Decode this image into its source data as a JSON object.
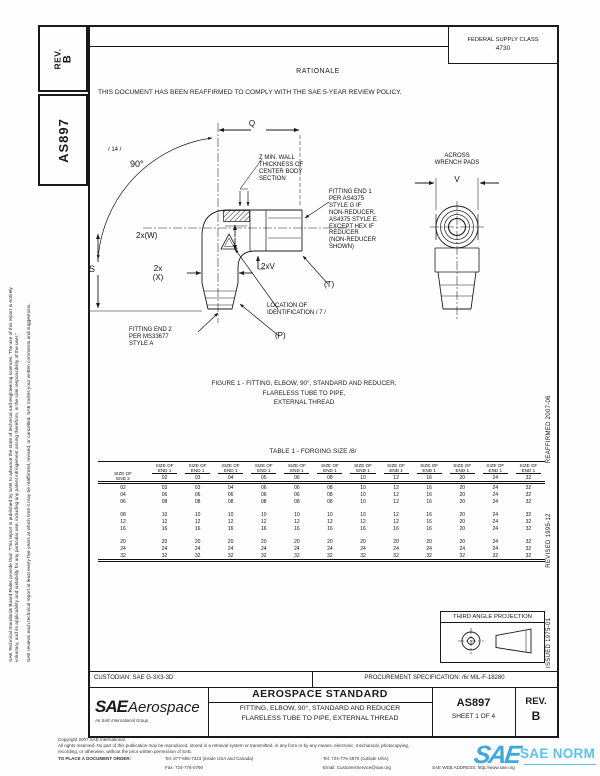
{
  "page": {
    "ink": "#1a1a1a",
    "watermark_blue": "#3fa9dc",
    "watermark_blue_light": "#5ec1ea"
  },
  "sidebar_left": {
    "disclaimer_line1": "SAE Technical Standards Board Rules provide that: \"This report is published by SAE to advance the state of technical and engineering sciences. The use of this report is entirely",
    "disclaimer_line2": "voluntary, and its applicability and suitability for any particular use, including any patent infringement arising therefrom, is the sole responsibility of the user.\"",
    "disclaimer_line3": "SAE reviews each technical report at least every five years at which time it may be reaffirmed, revised, or cancelled. SAE invites your written comments and suggestions.",
    "rev_label": "REV.",
    "rev_value": "B",
    "doc_number": "AS897"
  },
  "right_margin": {
    "issued": "ISSUED 1975-01",
    "revised": "REVISED 1995-12",
    "reaffirmed": "REAFFIRMED 2007-06"
  },
  "header": {
    "fsc_label": "FEDERAL SUPPLY CLASS",
    "fsc_value": "4730",
    "rationale_title": "RATIONALE",
    "rationale_text": "THIS DOCUMENT HAS BEEN REAFFIRMED TO COMPLY WITH THE SAE 5-YEAR REVIEW POLICY."
  },
  "figure": {
    "labels": {
      "flag_14": "/ 14 /",
      "angle_90": "90°",
      "dim_q": "Q",
      "z_note": "Z MIN. WALL\nTHICKNESS OF\nCENTER BODY\nSECTION",
      "end1_note": "FITTING END 1\nPER AS4375\nSTYLE G IF\nNON-REDUCER,\nAS4375 STYLE E\nEXCEPT HEX IF\nREDUCER\n(NON-REDUCER\nSHOWN)",
      "dim_2xw": "2x(W)",
      "dim_2xx": "2x\n(X)",
      "dim_s": "S",
      "dim_2xv": "2xV",
      "dim_t": "(T)",
      "id_note": "LOCATION OF\nIDENTIFICATION / 7 /",
      "dim_p": "(P)",
      "end2_note": "FITTING END 2\nPER MS33677\nSTYLE A",
      "across_wrench": "ACROSS\nWRENCH PADS",
      "dim_v": "V"
    },
    "caption": "FIGURE 1 - FITTING, ELBOW, 90°, STANDARD AND REDUCER,\nFLARELESS TUBE TO PIPE,\nEXTERNAL THREAD"
  },
  "table": {
    "title": "TABLE 1 - FORGING SIZE /8/",
    "corner_header": [
      "SIZE OF",
      "END 2"
    ],
    "col_header": [
      "SIZE OF",
      "END 1"
    ],
    "columns": [
      "02",
      "03",
      "04",
      "05",
      "06",
      "08",
      "10",
      "12",
      "16",
      "20",
      "24",
      "32"
    ],
    "row_groups": [
      {
        "rows": [
          {
            "end2": "02",
            "values": [
              "03",
              "03",
              "04",
              "06",
              "06",
              "08",
              "10",
              "12",
              "16",
              "20",
              "24",
              "32"
            ]
          },
          {
            "end2": "04",
            "values": [
              "06",
              "06",
              "06",
              "06",
              "06",
              "08",
              "10",
              "12",
              "16",
              "20",
              "24",
              "32"
            ]
          },
          {
            "end2": "06",
            "values": [
              "08",
              "08",
              "08",
              "08",
              "08",
              "08",
              "10",
              "12",
              "16",
              "20",
              "24",
              "32"
            ]
          }
        ]
      },
      {
        "rows": [
          {
            "end2": "08",
            "values": [
              "10",
              "10",
              "10",
              "10",
              "10",
              "10",
              "10",
              "12",
              "16",
              "20",
              "24",
              "32"
            ]
          },
          {
            "end2": "12",
            "values": [
              "12",
              "12",
              "12",
              "12",
              "12",
              "12",
              "12",
              "12",
              "16",
              "20",
              "24",
              "32"
            ]
          },
          {
            "end2": "16",
            "values": [
              "16",
              "16",
              "16",
              "16",
              "16",
              "16",
              "16",
              "16",
              "16",
              "20",
              "24",
              "32"
            ]
          }
        ]
      },
      {
        "rows": [
          {
            "end2": "20",
            "values": [
              "20",
              "20",
              "20",
              "20",
              "20",
              "20",
              "20",
              "20",
              "20",
              "20",
              "24",
              "32"
            ]
          },
          {
            "end2": "24",
            "values": [
              "24",
              "24",
              "24",
              "24",
              "24",
              "24",
              "24",
              "24",
              "24",
              "24",
              "24",
              "32"
            ]
          },
          {
            "end2": "32",
            "values": [
              "32",
              "32",
              "32",
              "32",
              "32",
              "32",
              "32",
              "32",
              "32",
              "32",
              "32",
              "32"
            ]
          }
        ]
      }
    ]
  },
  "projection": {
    "label": "THIRD ANGLE PROJECTION"
  },
  "title_block": {
    "custodian": "CUSTODIAN: SAE G-3X3-3D",
    "procurement": "PROCUREMENT SPECIFICATION: /6/ MIL-F-18280",
    "standard_type": "AEROSPACE STANDARD",
    "doc_title_line1": "FITTING, ELBOW, 90°, STANDARD AND REDUCER",
    "doc_title_line2": "FLARELESS TUBE TO PIPE, EXTERNAL THREAD",
    "doc_number": "AS897",
    "sheet": "SHEET 1 OF 4",
    "rev_label": "REV.",
    "rev_value": "B",
    "logo_sae": "SAE",
    "logo_aerospace": "Aerospace",
    "logo_tagline": "An SAE International Group"
  },
  "footer": {
    "copyright": "Copyright 2007 SAE International",
    "rights_line1": "All rights reserved. No part of this publication may be reproduced, stored in a retrieval system or transmitted, in any form or by any means, electronic, mechanical, photocopying,",
    "rights_line2": "recording, or otherwise, without the prior written permission of SAE.",
    "order_label": "TO PLACE A DOCUMENT ORDER:",
    "tel_inside": "Tel: 877-606-7323 (inside USA and Canada)",
    "tel_outside": "Tel: 724-776-4970 (outside USA)",
    "fax": "Fax: 724-776-0790",
    "email": "Email: CustomerService@sae.org",
    "web": "SAE WEB ADDRESS: http://www.sae.org",
    "watermark_sae": "SAE",
    "watermark_norm": "SAE NORM"
  }
}
